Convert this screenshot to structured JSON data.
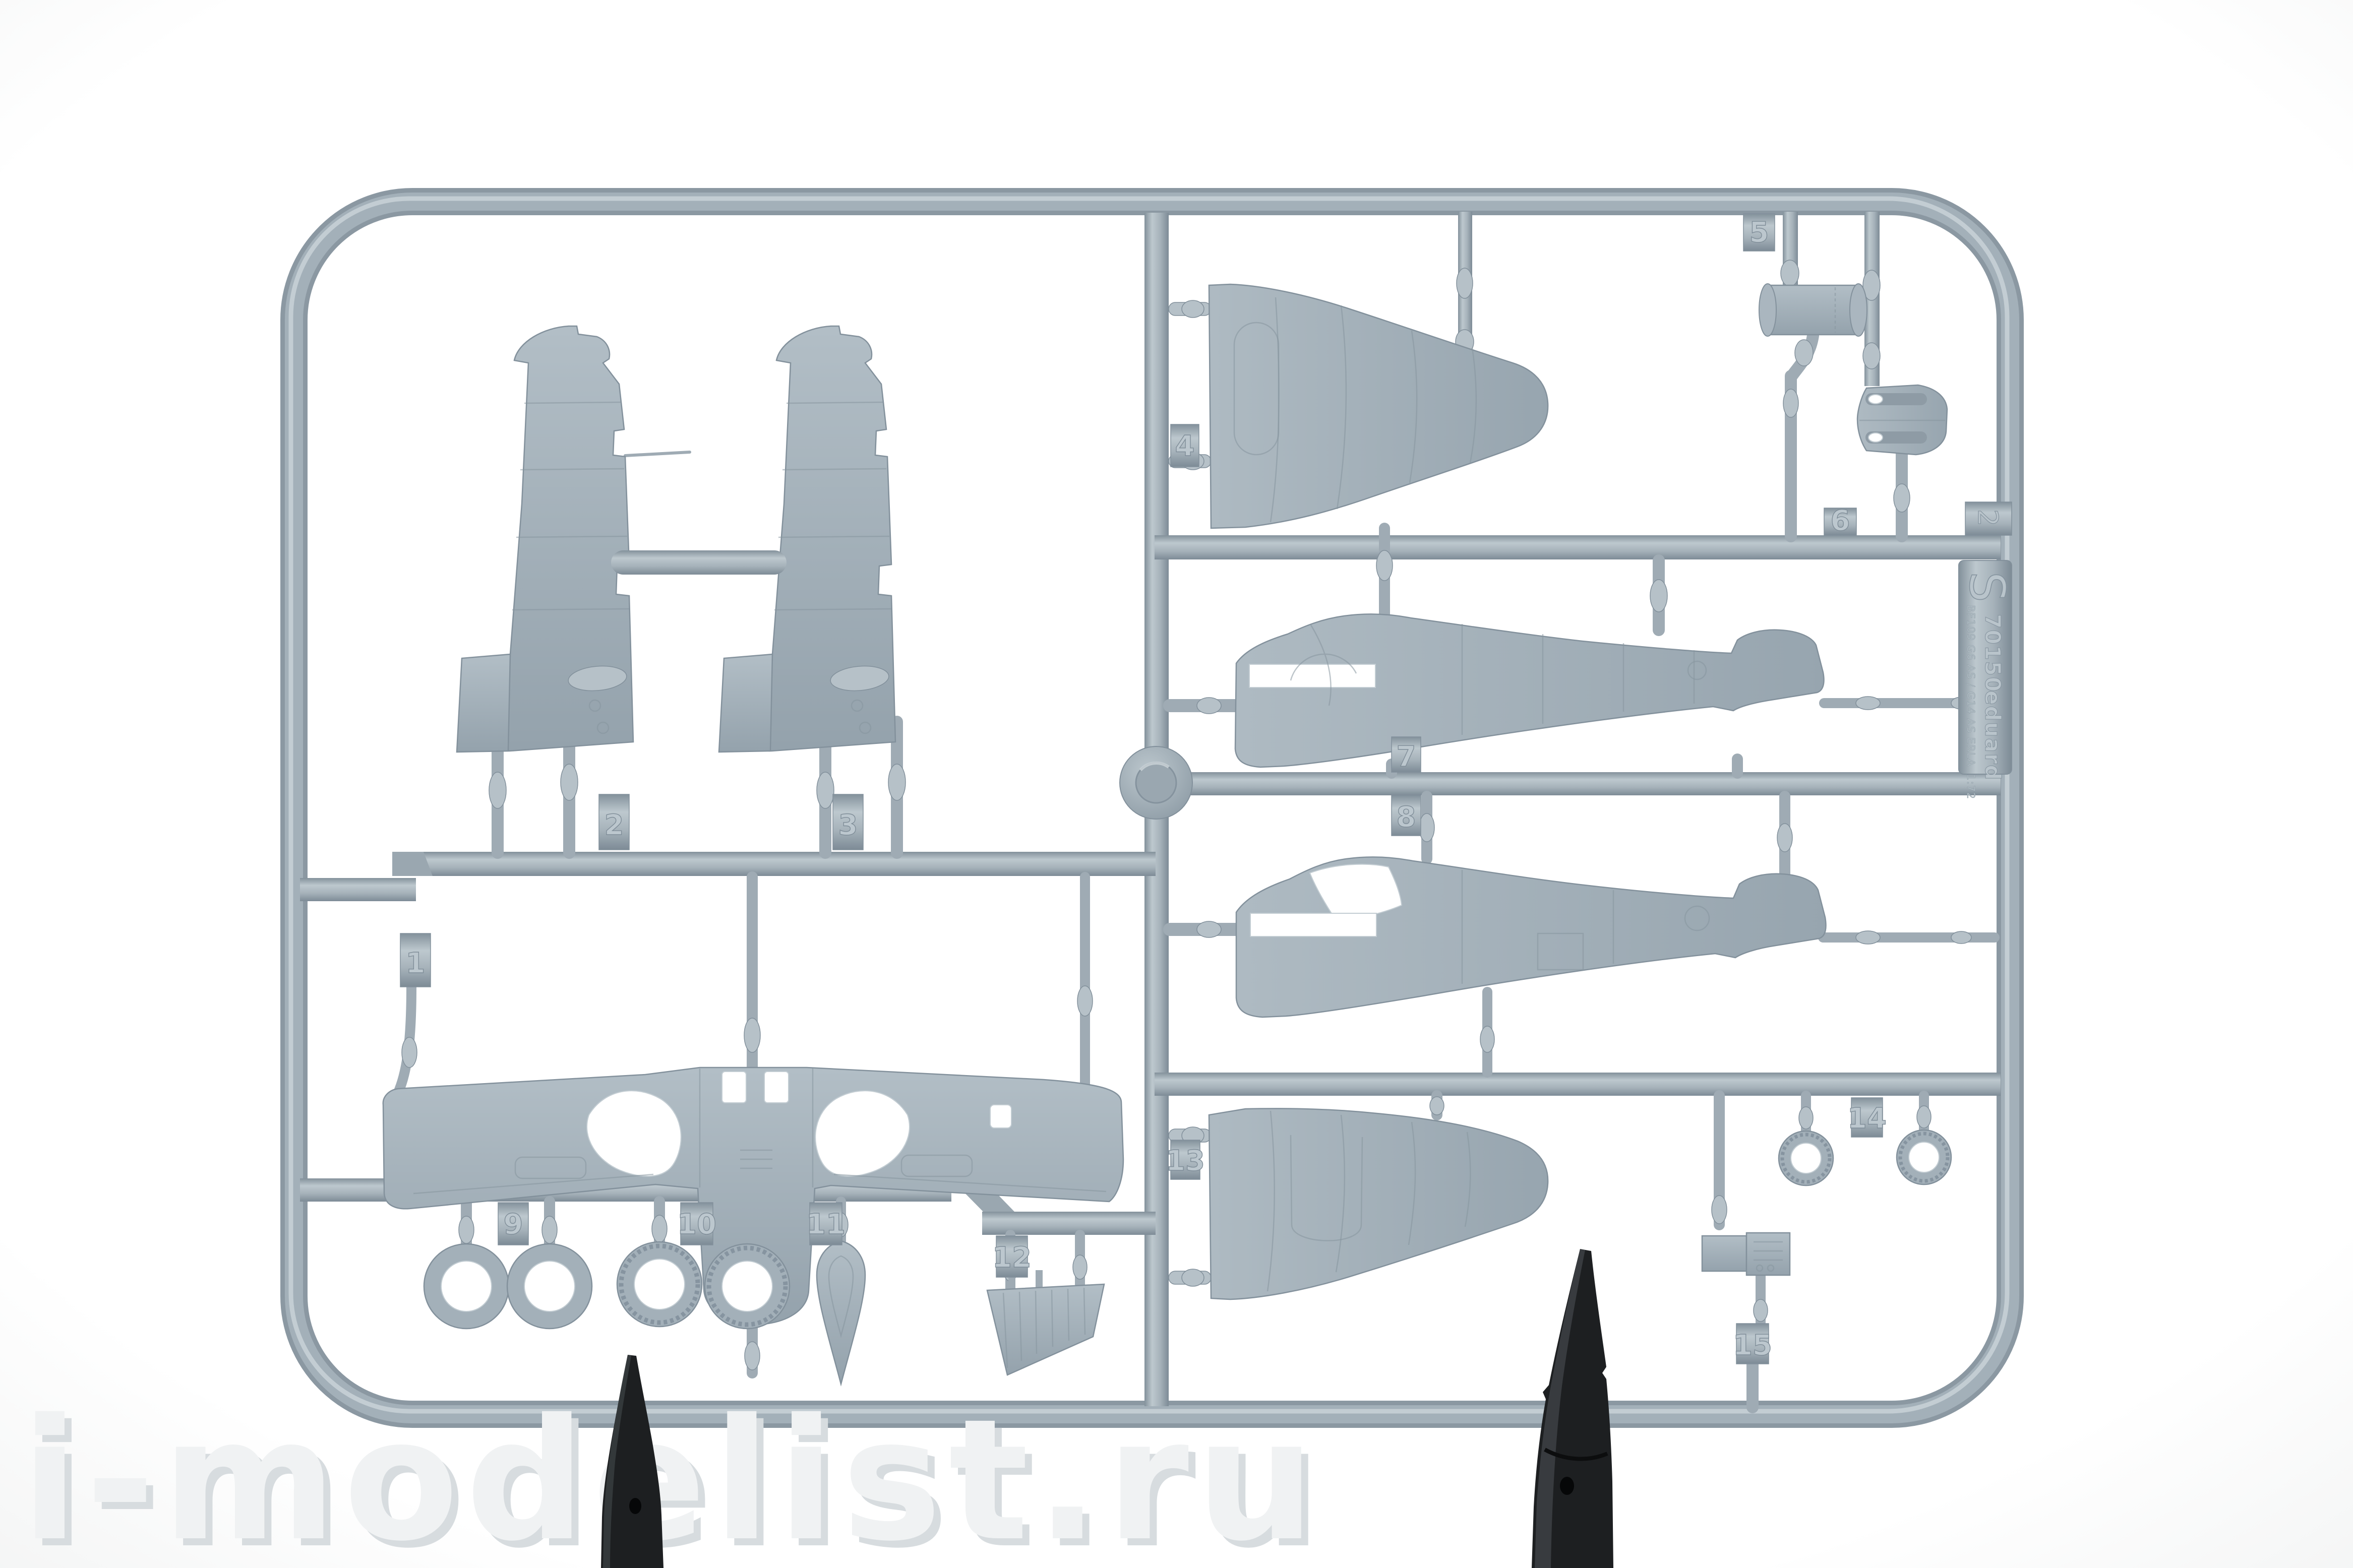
{
  "watermark": {
    "text": "i-modelist.ru"
  },
  "sprue_plate": {
    "edge_tab_number": "2",
    "sprue_letter": "S",
    "kit_number": "70150",
    "brand": "eduard",
    "subject": "BF109 G6 AS / G14 AS ERLA",
    "scale": "1:72"
  },
  "part_tabs": [
    {
      "number": "1"
    },
    {
      "number": "2"
    },
    {
      "number": "3"
    },
    {
      "number": "4"
    },
    {
      "number": "5"
    },
    {
      "number": "6"
    },
    {
      "number": "7"
    },
    {
      "number": "8"
    },
    {
      "number": "9"
    },
    {
      "number": "10"
    },
    {
      "number": "11"
    },
    {
      "number": "12"
    },
    {
      "number": "13"
    },
    {
      "number": "14"
    },
    {
      "number": "15"
    }
  ],
  "colors": {
    "background": "#ffffff",
    "plastic": "#9fabb4",
    "plastic_light": "#c6d0d6",
    "plastic_dark": "#82909b",
    "clip": "#1d1f21",
    "watermark": "#e9ecee"
  }
}
